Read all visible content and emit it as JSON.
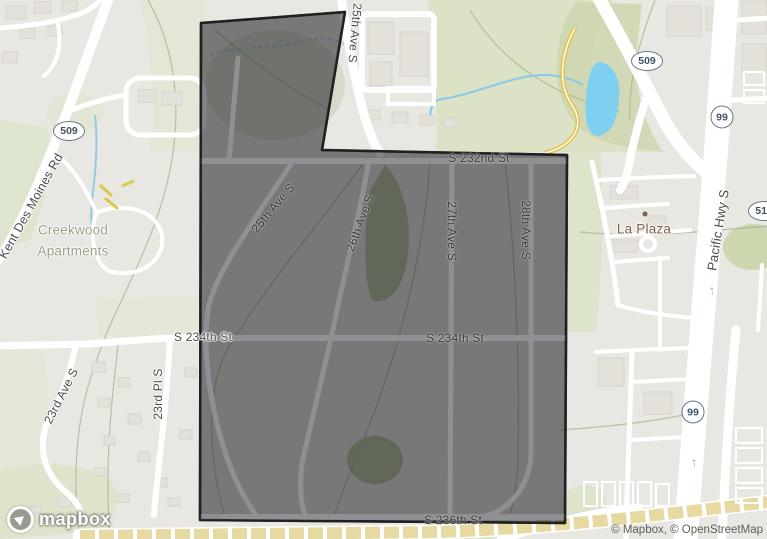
{
  "attribution": {
    "part1": "© Mapbox, ",
    "part2": "© OpenStreetMap"
  },
  "logo": {
    "wordmark": "mapbox"
  },
  "icons": {
    "one_way_arrow": "↑"
  },
  "shields": {
    "sr509_left": "509",
    "sr509_right": "509",
    "hwy99_top": "99",
    "hwy99_bottom": "99",
    "sr516": "516"
  },
  "labels": {
    "kent_des_moines_rd": "Kent Des Moines Rd",
    "creekwood_line1": "Creekwood",
    "creekwood_line2": "Apartments",
    "ave25_top": "25th Ave S",
    "ave25_inner": "25th Ave S",
    "ave26": "26th Ave S",
    "ave27": "27th Ave S",
    "ave28": "28th Ave S",
    "st232": "S 232nd St",
    "st234_west": "S 234th St",
    "st234_inner": "S 234th St",
    "st236": "S 236th St",
    "ave23": "23rd Ave S",
    "pl23": "23rd Pl S",
    "la_plaza": "La Plaza",
    "pacific_hwy": "Pacific Hwy S"
  },
  "colors": {
    "land": "#e9e7e2",
    "park_green": "#dce3c9",
    "water_blue": "#7fd0f0",
    "road_white": "#ffffff",
    "construction_tan": "#e7d9a2",
    "overlay_fill": "rgba(20,20,24,0.52)",
    "overlay_border": "#2e2e30",
    "shield_border": "#64788c",
    "street_label": "#4b4b4b",
    "poi_brown": "#7d5f4d",
    "area_label_olive": "#a19c85"
  }
}
